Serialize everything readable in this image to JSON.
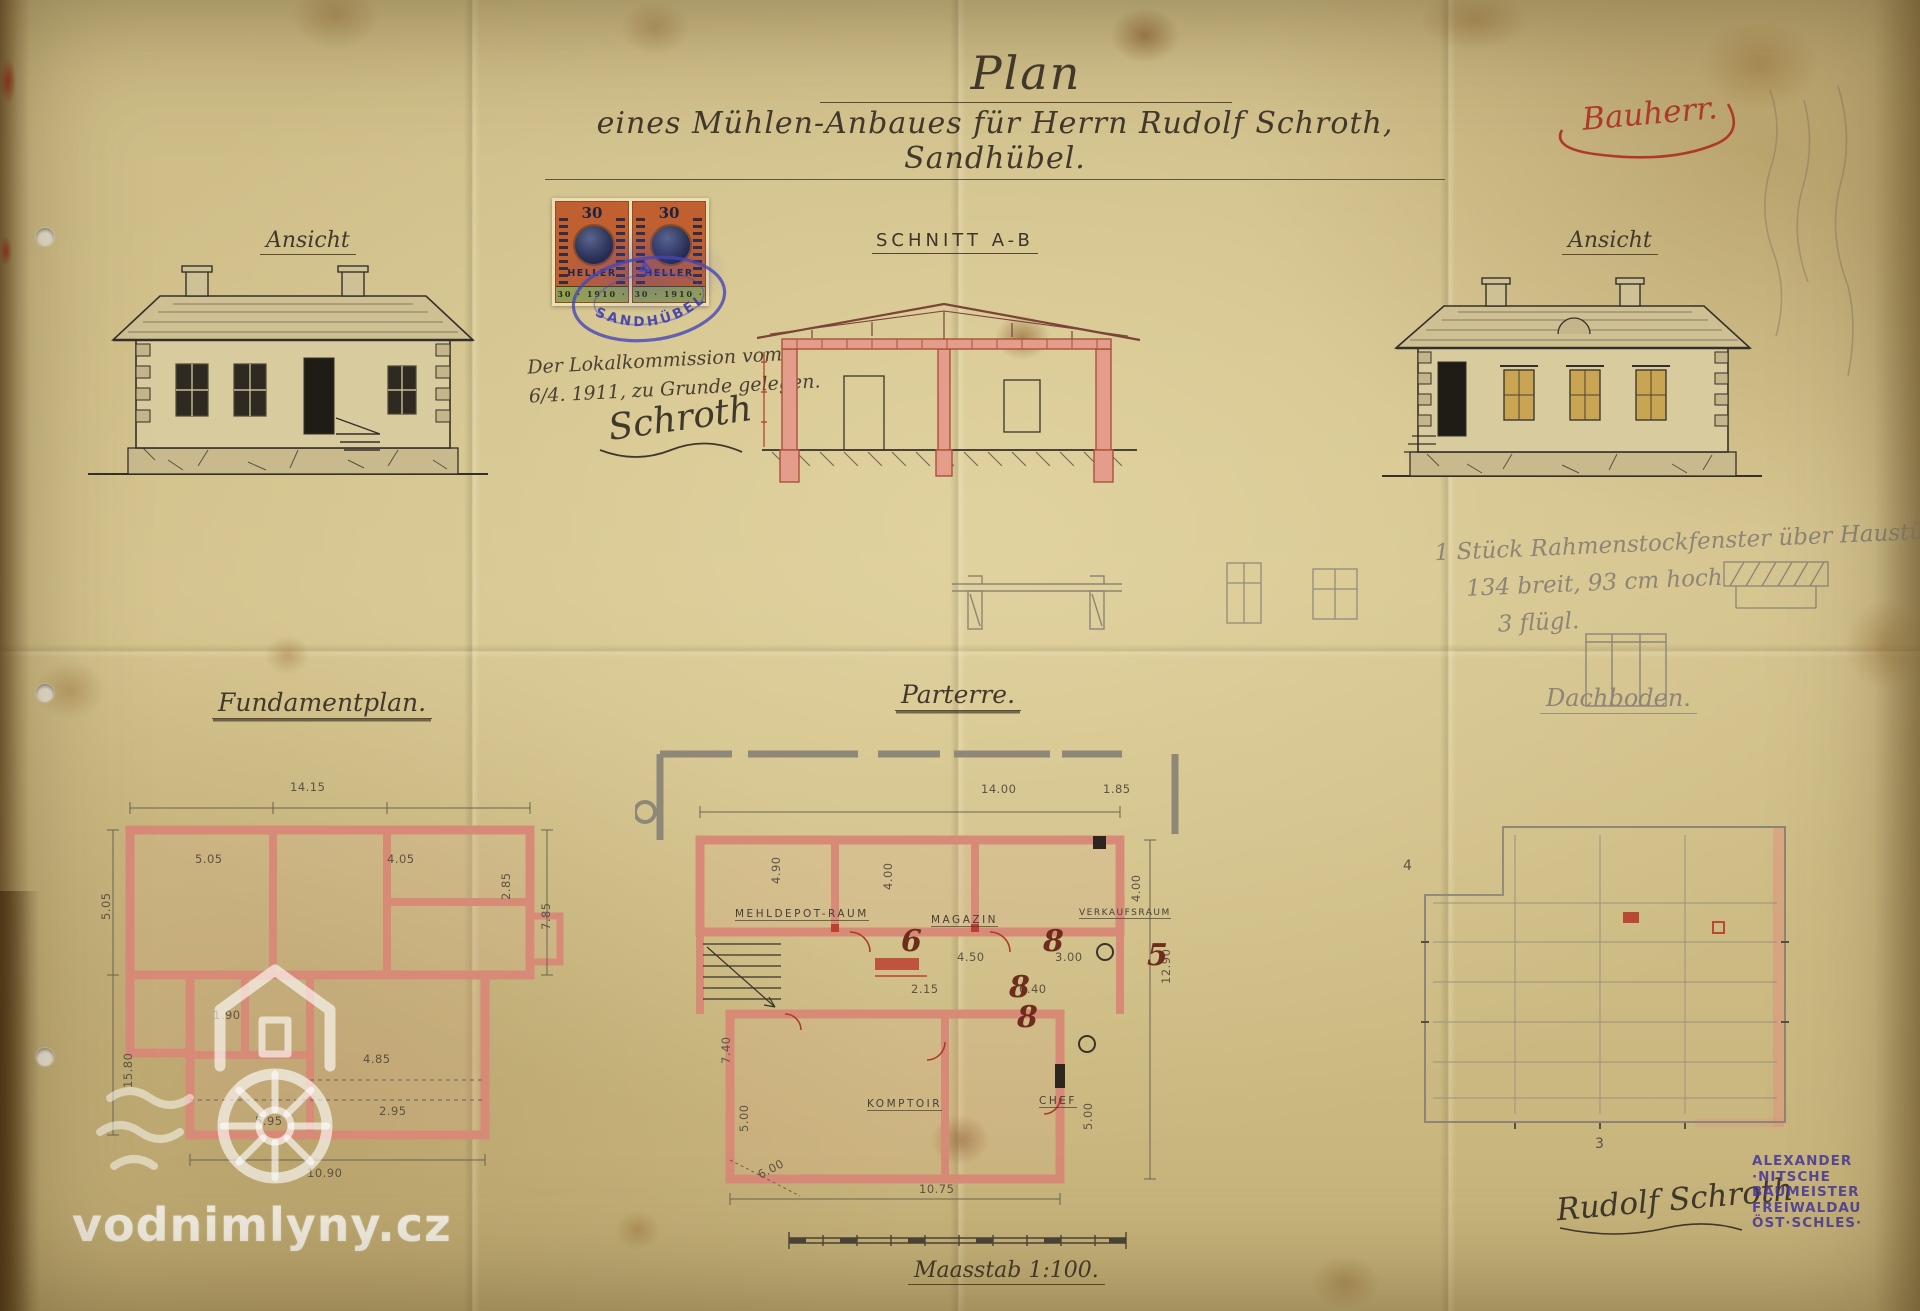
{
  "header": {
    "title": "Plan",
    "subtitle": "eines Mühlen-Anbaues für Herrn Rudolf Schroth, Sandhübel.",
    "owner_note": "Bauherr."
  },
  "labels": {
    "elevation_left": "Ansicht",
    "section": "SCHNITT A-B",
    "elevation_right": "Ansicht",
    "foundation": "Fundamentplan.",
    "ground_floor": "Parterre.",
    "attic": "Dachboden.",
    "scale": "Maasstab 1:100."
  },
  "revenue_stamp": {
    "value": "30",
    "currency": "HELLER",
    "year_band": "30 · 1910 · 30",
    "postmark": "SANDHÜBEL"
  },
  "approval_note": {
    "line1": "Der Lokalkommission vom",
    "line2": "6/4. 1911, zu Grunde gelegen.",
    "signature": "Schroth"
  },
  "pencil_note": {
    "line1": "1 Stück Rahmenstockfenster über Haustüre",
    "line2": "134 breit, 93 cm hoch",
    "line3": "3 flügl."
  },
  "rooms": {
    "mehldepot": "MEHLDEPOT-RAUM",
    "magazin": "MAGAZIN",
    "verkauf": "VERKAUFSRAUM",
    "komptoir": "KOMPTOIR",
    "chef": "CHEF"
  },
  "fundament_dims": {
    "top": "14.15",
    "cell1": "5.05",
    "cell2": "4.05",
    "right_upper": "2.85",
    "right_side": "7.85",
    "left_side": "5.05",
    "mid": "1.90",
    "low1": "4.85",
    "low2": "2.95",
    "low3": "5.95",
    "left_lower": "15.80",
    "bottom": "10.90"
  },
  "parterre_dims": {
    "top": "14.00",
    "top_right": "1.85",
    "left": "4.90",
    "mid1": "4.50",
    "mid2": "3.00",
    "right_side": "12.90",
    "corr1": "2.15",
    "corr2": "6.40",
    "left_lower": "7.40",
    "left_bottom": "5.00",
    "mehl_height": "4.00",
    "verkauf_height": "4.00",
    "chef_height": "5.00",
    "bottom": "10.75",
    "diag": "6.00"
  },
  "parterre_marks": {
    "m1": "6",
    "m2": "8",
    "m3": "5",
    "m4": "8",
    "m5": "8"
  },
  "attic_marks": {
    "left": "4",
    "bottom": "3"
  },
  "maker_stamp": {
    "line1": "ALEXANDER",
    "line2": "·NITSCHE",
    "line3": "BAUMEISTER",
    "line4": "FREIWALDAU",
    "line5": "ÖST·SCHLES·"
  },
  "signature_owner": "Rudolf Schroth",
  "watermark": "vodnimlyny.cz",
  "colors": {
    "paper": "#d3c28c",
    "sepia_ink": "#42392c",
    "pencil": "#8d8577",
    "pink_wall": "#d78b77",
    "red_ink": "#b03a2a",
    "purple_stamp": "#4c3c99",
    "stamp_orange": "#c06030",
    "stamp_navy": "#1e2340",
    "stamp_green": "#94a055",
    "postmark_blue": "#4646b9"
  }
}
